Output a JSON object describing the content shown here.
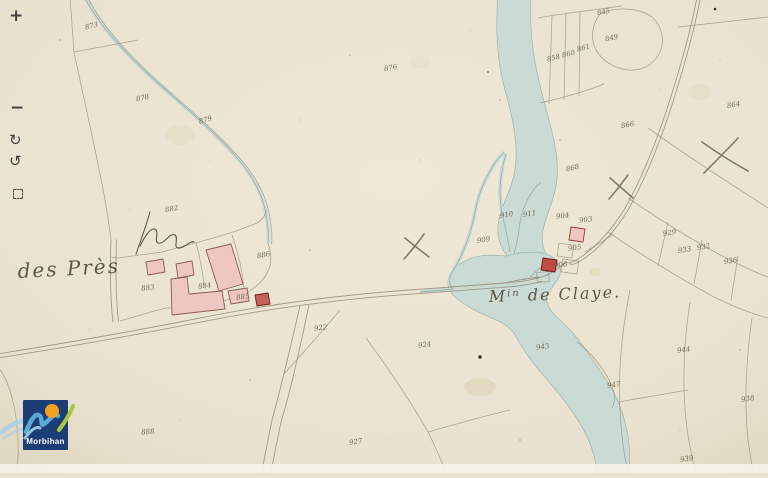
{
  "theme": {
    "paper": "#eae2d0",
    "paper_light": "#efe8d7",
    "paper_dark": "#ddd3bd",
    "river": "#c9dbd7",
    "river_edge": "#9fb7b1",
    "ditch_line": "#8fa391",
    "line": "#867c63",
    "building_pink": "#eec6c2",
    "building_red": "#bf4a42",
    "building_stroke": "#8a5f52",
    "building_red_stroke": "#6f1f1a",
    "ink": "#6b604a",
    "label_ink": "#55503f",
    "pencil": "#6e695e",
    "scribble_ink": "#46412f",
    "control_ink": "#2b2b2b",
    "sheet_strip": "#f6f3ea",
    "logo_navy": "#1d3d77",
    "logo_blue": "#5aaad6",
    "logo_blue_light": "#aacfe6",
    "logo_orange": "#f4a11d",
    "logo_green": "#abc63e",
    "logo_text_color": "#ffffff"
  },
  "controls": {
    "zoom_in": "+",
    "zoom_out": "−",
    "rotate_cw": "↻",
    "rotate_ccw": "↺"
  },
  "logo": {
    "name": "Morbihan"
  },
  "map": {
    "place_labels": [
      {
        "text": "des Près",
        "x": 18,
        "y": 278,
        "size": 20,
        "rotate": -3
      },
      {
        "prefix": "M",
        "sup": "in",
        "rest": " de Claye.",
        "x": 489,
        "y": 302,
        "size": 16,
        "rotate": -2
      }
    ],
    "parcel_numbers": [
      {
        "t": "873",
        "x": 92,
        "y": 28,
        "r": -14
      },
      {
        "t": "878",
        "x": 143,
        "y": 100,
        "r": -12
      },
      {
        "t": "879",
        "x": 206,
        "y": 122,
        "r": -15
      },
      {
        "t": "876",
        "x": 391,
        "y": 70,
        "r": -10
      },
      {
        "t": "845",
        "x": 604,
        "y": 14,
        "r": -12
      },
      {
        "t": "858",
        "x": 554,
        "y": 60,
        "r": -14
      },
      {
        "t": "860",
        "x": 569,
        "y": 56,
        "r": -14
      },
      {
        "t": "861",
        "x": 584,
        "y": 50,
        "r": -14
      },
      {
        "t": "849",
        "x": 612,
        "y": 40,
        "r": -12
      },
      {
        "t": "864",
        "x": 734,
        "y": 107,
        "r": -10
      },
      {
        "t": "866",
        "x": 628,
        "y": 127,
        "r": -10
      },
      {
        "t": "868",
        "x": 573,
        "y": 170,
        "r": -12
      },
      {
        "t": "882",
        "x": 172,
        "y": 211,
        "r": -10
      },
      {
        "t": "883",
        "x": 148,
        "y": 290,
        "r": -6
      },
      {
        "t": "884",
        "x": 205,
        "y": 288,
        "r": -8
      },
      {
        "t": "885",
        "x": 243,
        "y": 299,
        "r": -6
      },
      {
        "t": "886",
        "x": 264,
        "y": 257,
        "r": -10
      },
      {
        "t": "903",
        "x": 586,
        "y": 222,
        "r": -8
      },
      {
        "t": "904",
        "x": 563,
        "y": 218,
        "r": -8
      },
      {
        "t": "905",
        "x": 575,
        "y": 250,
        "r": -8
      },
      {
        "t": "906",
        "x": 561,
        "y": 267,
        "r": -8
      },
      {
        "t": "910",
        "x": 507,
        "y": 217,
        "r": -10
      },
      {
        "t": "911",
        "x": 530,
        "y": 216,
        "r": -10
      },
      {
        "t": "909",
        "x": 484,
        "y": 242,
        "r": -10
      },
      {
        "t": "929",
        "x": 670,
        "y": 235,
        "r": -10
      },
      {
        "t": "933",
        "x": 685,
        "y": 252,
        "r": -10
      },
      {
        "t": "932",
        "x": 704,
        "y": 249,
        "r": -10
      },
      {
        "t": "936",
        "x": 731,
        "y": 263,
        "r": -10
      },
      {
        "t": "922",
        "x": 321,
        "y": 330,
        "r": -8
      },
      {
        "t": "924",
        "x": 425,
        "y": 347,
        "r": -8
      },
      {
        "t": "943",
        "x": 543,
        "y": 349,
        "r": -8
      },
      {
        "t": "944",
        "x": 684,
        "y": 352,
        "r": -8
      },
      {
        "t": "947",
        "x": 614,
        "y": 387,
        "r": -8
      },
      {
        "t": "938",
        "x": 748,
        "y": 401,
        "r": -8
      },
      {
        "t": "939",
        "x": 687,
        "y": 461,
        "r": -8
      },
      {
        "t": "927",
        "x": 356,
        "y": 444,
        "r": -8
      },
      {
        "t": "888",
        "x": 148,
        "y": 434,
        "r": -4
      }
    ]
  }
}
